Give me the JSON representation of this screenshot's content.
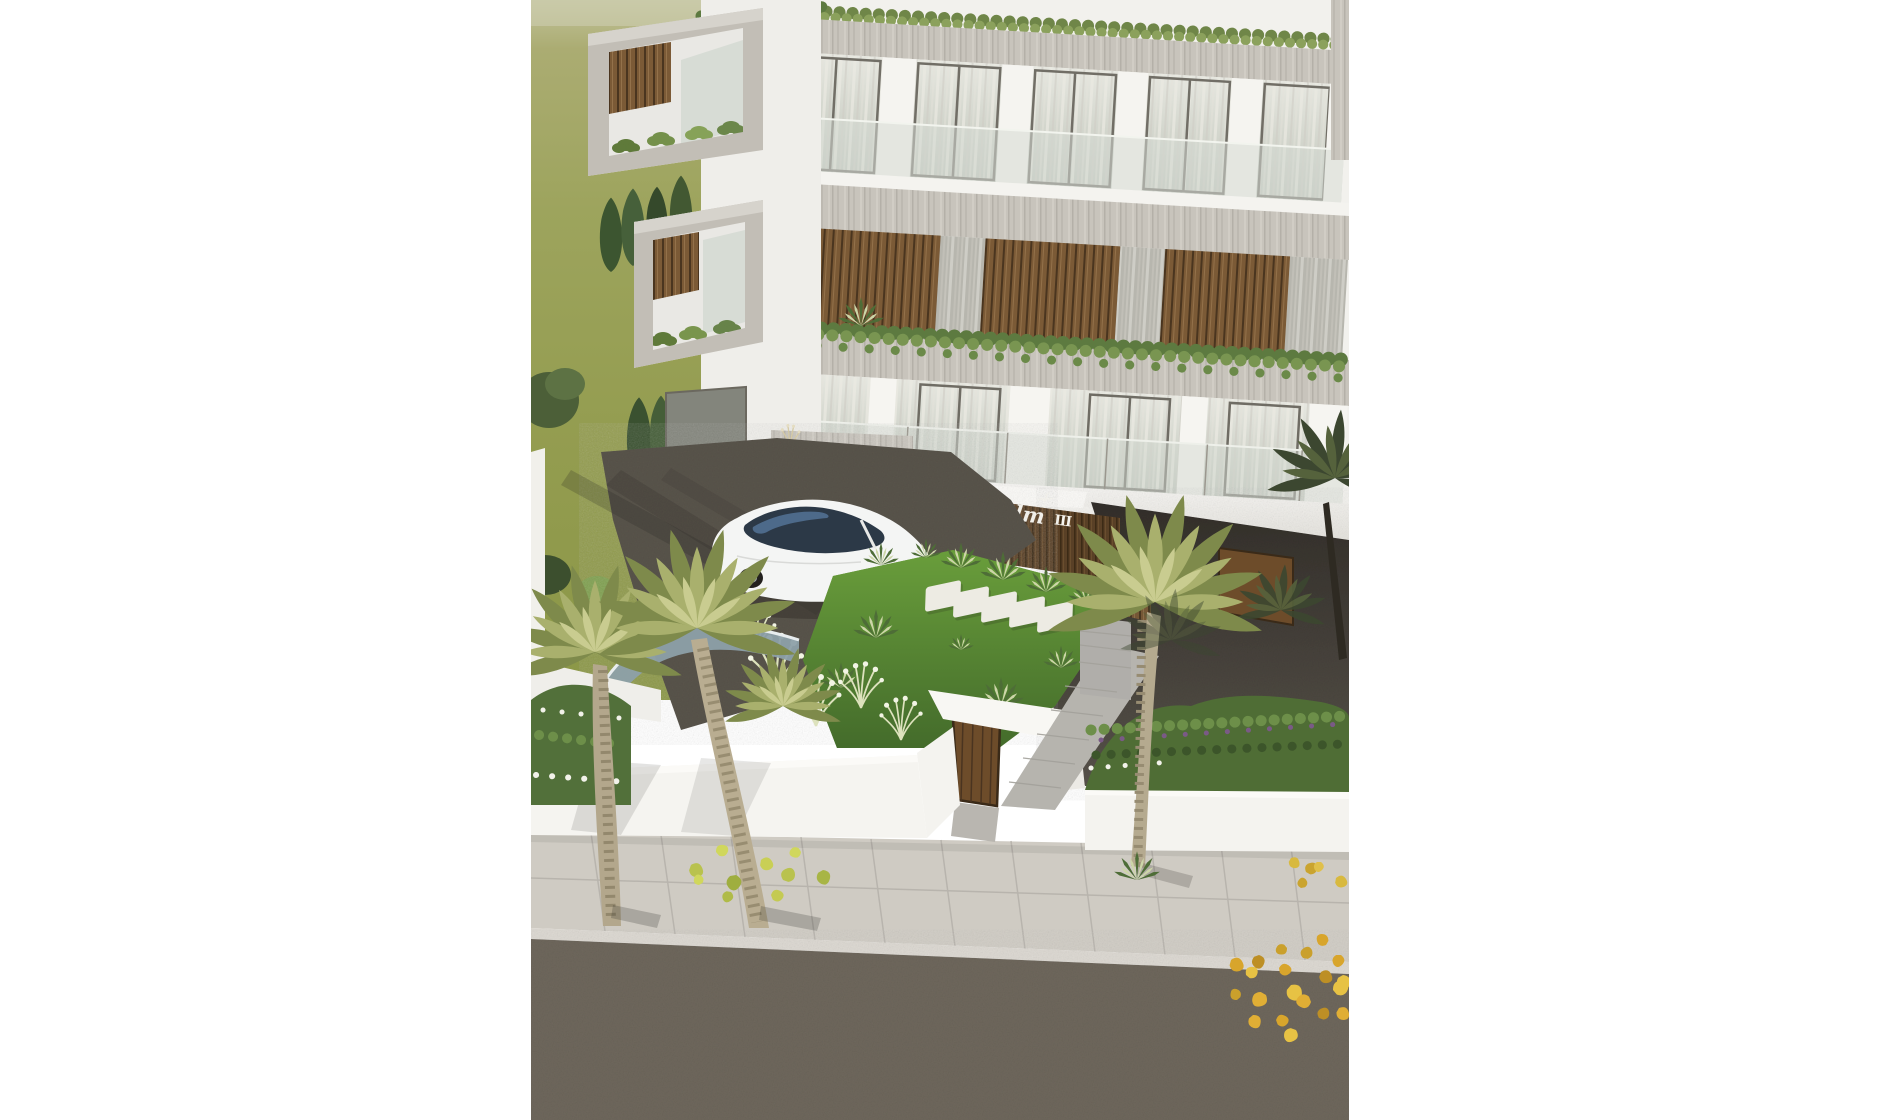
{
  "sign": {
    "brand": "Palm",
    "numeral": "III",
    "color": "#f7f5ef"
  },
  "palette": {
    "canvas": "#ffffff",
    "grass_field": "#9aa355",
    "lawn": "#5c8a33",
    "building_white": "#f2f1ed",
    "concrete_band": "#c6c2ba",
    "wood_slats": "#7b5a36",
    "sign_wall": "#553d24",
    "gate_door": "#6d4c2a",
    "driveway_asphalt": "#59544b",
    "street_asphalt": "#6e675c",
    "sidewalk": "#cfcbc3",
    "glass": "#ccd1c9",
    "car_body": "#f4f5f4",
    "fallen_leaves": "#dfa932"
  }
}
